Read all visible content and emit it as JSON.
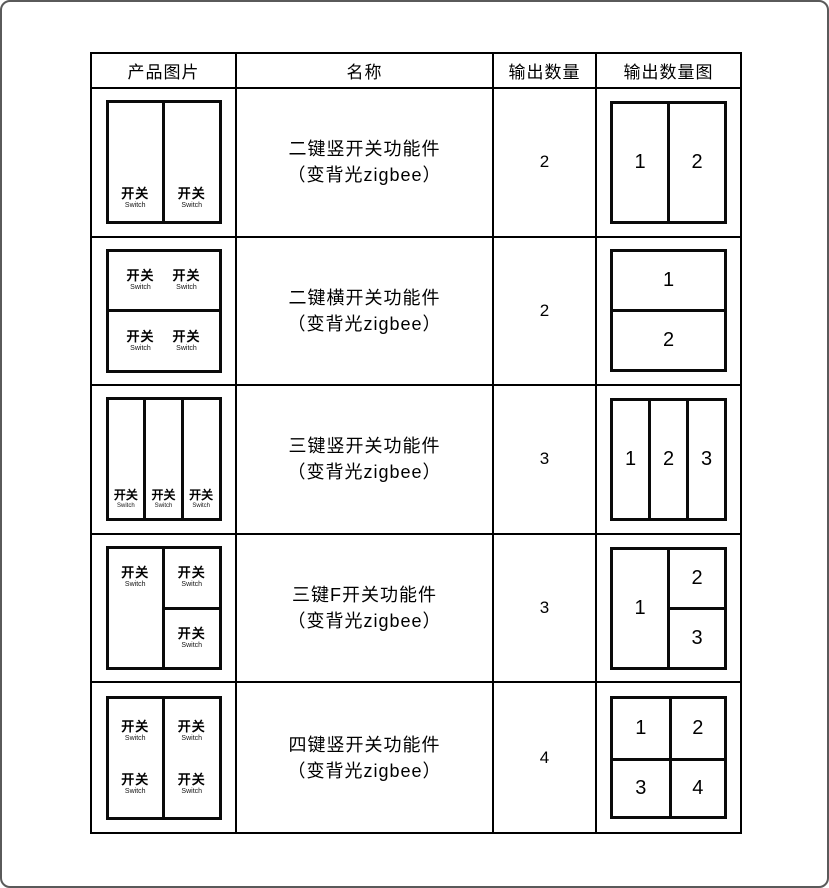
{
  "header": {
    "product_image": "产品图片",
    "name": "名称",
    "output_quantity": "输出数量",
    "output_quantity_diagram": "输出数量图"
  },
  "labels": {
    "kai_guan": "开关",
    "switch": "Switch"
  },
  "rows": [
    {
      "name_line1": "二键竖开关功能件",
      "name_line2": "（变背光zigbee）",
      "quantity": "2",
      "diagram": {
        "layout": "2-vertical",
        "cells": [
          "1",
          "2"
        ]
      }
    },
    {
      "name_line1": "二键横开关功能件",
      "name_line2": "（变背光zigbee）",
      "quantity": "2",
      "diagram": {
        "layout": "2-horizontal",
        "cells": [
          "1",
          "2"
        ]
      }
    },
    {
      "name_line1": "三键竖开关功能件",
      "name_line2": "（变背光zigbee）",
      "quantity": "3",
      "diagram": {
        "layout": "3-vertical",
        "cells": [
          "1",
          "2",
          "3"
        ]
      }
    },
    {
      "name_line1": "三键F开关功能件",
      "name_line2": "（变背光zigbee）",
      "quantity": "3",
      "diagram": {
        "layout": "f-split",
        "cells": [
          "1",
          "2",
          "3"
        ]
      }
    },
    {
      "name_line1": "四键竖开关功能件",
      "name_line2": "（变背光zigbee）",
      "quantity": "4",
      "diagram": {
        "layout": "2x2-grid",
        "cells": [
          "1",
          "2",
          "3",
          "4"
        ]
      }
    }
  ]
}
